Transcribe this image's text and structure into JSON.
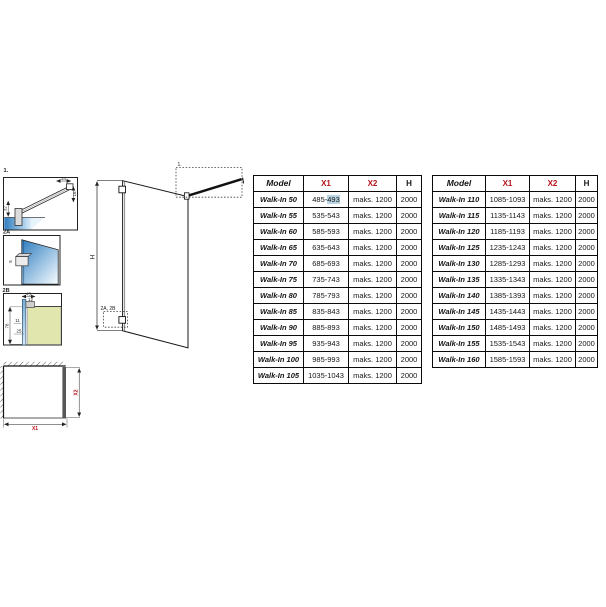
{
  "colors": {
    "accent_red": "#b5121b",
    "selection_highlight": "#b9d4e2",
    "glass_blue_dark": "#2e7dbf",
    "glass_blue_light": "#e8f4fc",
    "tray_green": "#e1e6af",
    "plan_glass_gray": "#575757"
  },
  "diagram": {
    "detail1": {
      "label": "1.",
      "dim_top": "34",
      "dim_right": "16",
      "dim_left": "32"
    },
    "detail2a": {
      "label": "2A",
      "dim": "5"
    },
    "detail2b": {
      "label": "2B",
      "dim_top": "45",
      "dim_top2": "12",
      "dim_left": "78",
      "dim_mid": "11",
      "dim_bottom": "25"
    },
    "elevation": {
      "height_label": "H",
      "callout_top": "1.",
      "callout_bottom": "2A, 2B"
    },
    "plan": {
      "width_label": "X1",
      "depth_label": "X2"
    }
  },
  "tables": [
    {
      "headers": {
        "model": "Model",
        "x1": "X1",
        "x2": "X2",
        "h": "H"
      },
      "col_keys": [
        "model",
        "x1",
        "x2",
        "h"
      ],
      "rows": [
        {
          "model": "Walk-In 50",
          "x1": "485-493",
          "x1_prefix": "485-",
          "x1_hl": "493",
          "x2": "maks. 1200",
          "h": "2000"
        },
        {
          "model": "Walk-In 55",
          "x1": "535-543",
          "x2": "maks. 1200",
          "h": "2000"
        },
        {
          "model": "Walk-In 60",
          "x1": "585-593",
          "x2": "maks. 1200",
          "h": "2000"
        },
        {
          "model": "Walk-In 65",
          "x1": "635-643",
          "x2": "maks. 1200",
          "h": "2000"
        },
        {
          "model": "Walk-In 70",
          "x1": "685-693",
          "x2": "maks. 1200",
          "h": "2000"
        },
        {
          "model": "Walk-In 75",
          "x1": "735-743",
          "x2": "maks. 1200",
          "h": "2000"
        },
        {
          "model": "Walk-In 80",
          "x1": "785-793",
          "x2": "maks. 1200",
          "h": "2000"
        },
        {
          "model": "Walk-In 85",
          "x1": "835-843",
          "x2": "maks. 1200",
          "h": "2000"
        },
        {
          "model": "Walk-In 90",
          "x1": "885-893",
          "x2": "maks. 1200",
          "h": "2000"
        },
        {
          "model": "Walk-In 95",
          "x1": "935-943",
          "x2": "maks. 1200",
          "h": "2000"
        },
        {
          "model": "Walk-In 100",
          "x1": "985-993",
          "x2": "maks. 1200",
          "h": "2000"
        },
        {
          "model": "Walk-In 105",
          "x1": "1035-1043",
          "x2": "maks. 1200",
          "h": "2000"
        }
      ]
    },
    {
      "headers": {
        "model": "Model",
        "x1": "X1",
        "x2": "X2",
        "h": "H"
      },
      "col_keys": [
        "model",
        "x1",
        "x2",
        "h"
      ],
      "rows": [
        {
          "model": "Walk-In 110",
          "x1": "1085-1093",
          "x2": "maks. 1200",
          "h": "2000"
        },
        {
          "model": "Walk-In 115",
          "x1": "1135-1143",
          "x2": "maks. 1200",
          "h": "2000"
        },
        {
          "model": "Walk-In 120",
          "x1": "1185-1193",
          "x2": "maks. 1200",
          "h": "2000"
        },
        {
          "model": "Walk-In 125",
          "x1": "1235-1243",
          "x2": "maks. 1200",
          "h": "2000"
        },
        {
          "model": "Walk-In 130",
          "x1": "1285-1293",
          "x2": "maks. 1200",
          "h": "2000"
        },
        {
          "model": "Walk-In 135",
          "x1": "1335-1343",
          "x2": "maks. 1200",
          "h": "2000"
        },
        {
          "model": "Walk-In 140",
          "x1": "1385-1393",
          "x2": "maks. 1200",
          "h": "2000"
        },
        {
          "model": "Walk-In 145",
          "x1": "1435-1443",
          "x2": "maks. 1200",
          "h": "2000"
        },
        {
          "model": "Walk-In 150",
          "x1": "1485-1493",
          "x2": "maks. 1200",
          "h": "2000"
        },
        {
          "model": "Walk-In 155",
          "x1": "1535-1543",
          "x2": "maks. 1200",
          "h": "2000"
        },
        {
          "model": "Walk-In 160",
          "x1": "1585-1593",
          "x2": "maks. 1200",
          "h": "2000"
        }
      ]
    }
  ]
}
